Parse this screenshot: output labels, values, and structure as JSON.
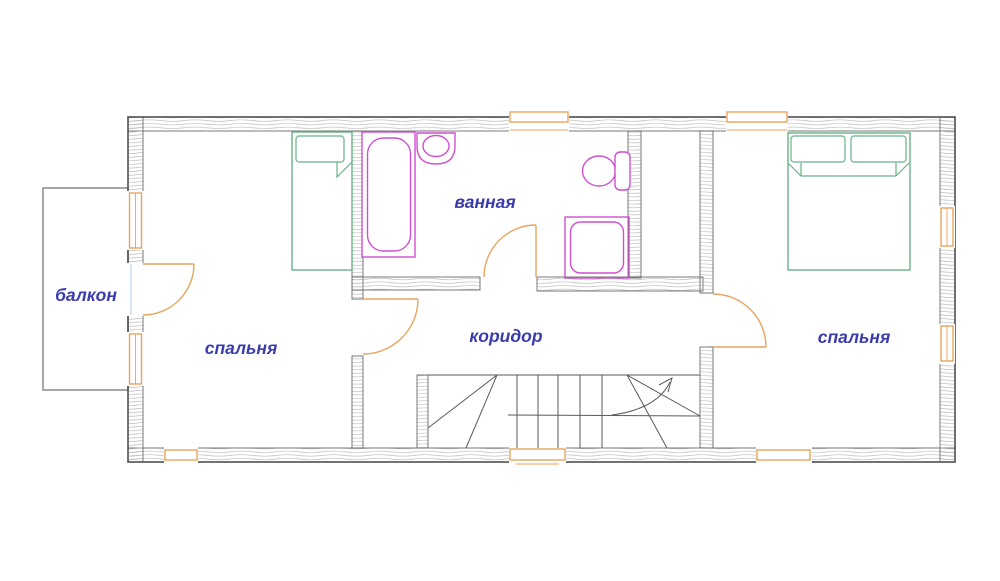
{
  "rooms": {
    "balcony": {
      "label": "балкон"
    },
    "bedroom_left": {
      "label": "спальня"
    },
    "bathroom": {
      "label": "ванная"
    },
    "corridor": {
      "label": "коридор"
    },
    "bedroom_right": {
      "label": "спальня"
    }
  },
  "fixtures": {
    "bathtub": "bathtub",
    "sink": "sink",
    "toilet": "toilet",
    "shower": "shower-cabin",
    "single_bed": "single-bed",
    "double_bed": "double-bed",
    "staircase": "staircase-with-up-arrow"
  },
  "palette": {
    "wall_outline": "#4f4f4f",
    "wall_hatch": "#b5b5b5",
    "window_frame": "#e8a45e",
    "door_swing": "#e8a45e",
    "sanitary": "#cf4fd0",
    "furniture": "#66b286",
    "label_text": "#3a3cae",
    "balcony_line": "#8a8a8a",
    "glass_line": "#bcd6e8"
  }
}
